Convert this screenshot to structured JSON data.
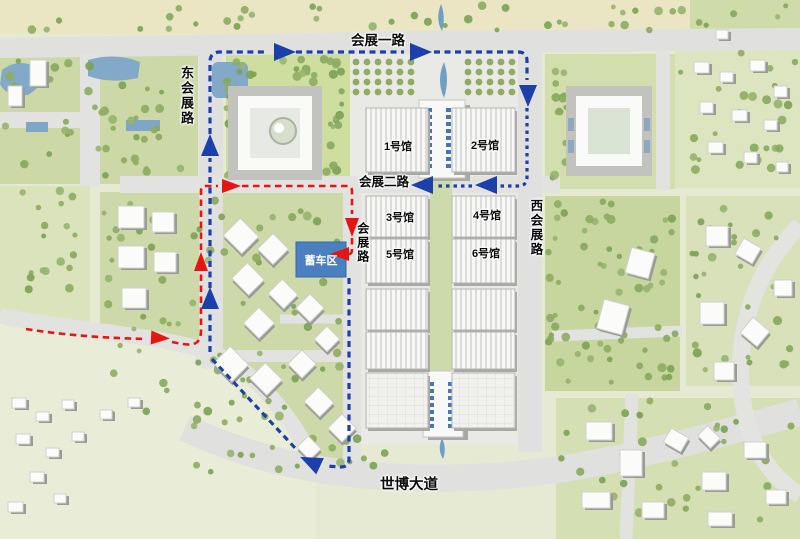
{
  "map": {
    "type": "exhibition-center-site-plan",
    "roads": [
      {
        "id": "huizhan-yi-lu",
        "label": "会展一路",
        "orientation": "horizontal"
      },
      {
        "id": "dong-huizhan-lu",
        "label": "东会展路",
        "orientation": "vertical"
      },
      {
        "id": "huizhan-er-lu",
        "label": "会展二路",
        "orientation": "horizontal"
      },
      {
        "id": "huizhan-lu",
        "label": "会展路",
        "orientation": "vertical"
      },
      {
        "id": "xi-huizhan-lu",
        "label": "西会展路",
        "orientation": "vertical"
      },
      {
        "id": "shibo-dadao",
        "label": "世博大道",
        "orientation": "horizontal"
      }
    ],
    "halls": [
      "1号馆",
      "2号馆",
      "3号馆",
      "4号馆",
      "5号馆",
      "6号馆"
    ],
    "staging_area": {
      "label": "蓄车区",
      "color": "#4b80c0"
    },
    "routes": {
      "blue": {
        "color": "#1c40ab",
        "style": "dashed",
        "arrows": 8
      },
      "red": {
        "color": "#e51511",
        "style": "dashed",
        "arrows": 5
      }
    }
  }
}
